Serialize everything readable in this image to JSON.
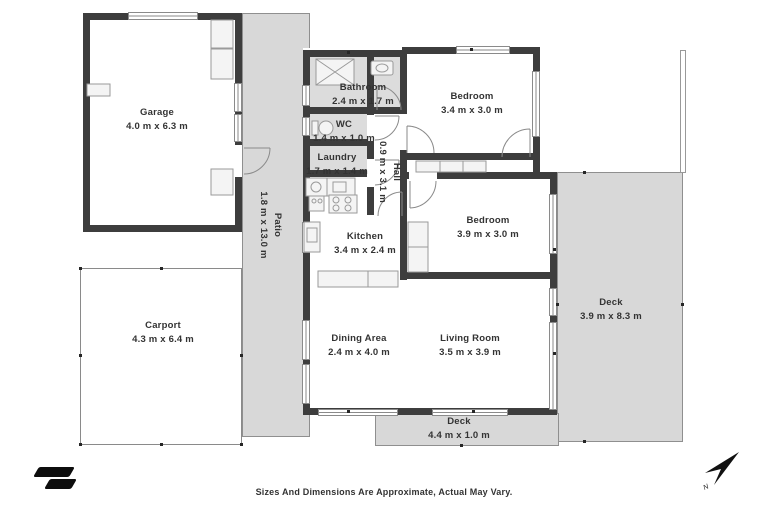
{
  "meta": {
    "footer_note": "Sizes And Dimensions Are Approximate, Actual May Vary.",
    "north_label": "N"
  },
  "colors": {
    "wall": "#3d3d3d",
    "outdoor_fill": "#d8d8d8",
    "wet_room_fill": "#dcdcdc",
    "fixture_line": "#9a9a9a",
    "label_text": "#333333"
  },
  "rooms": [
    {
      "id": "garage",
      "name": "Garage",
      "dimensions": "4.0 m x 6.3 m"
    },
    {
      "id": "carport",
      "name": "Carport",
      "dimensions": "4.3 m x 6.4 m"
    },
    {
      "id": "patio",
      "name": "Patio",
      "dimensions": "1.8 m x 13.0 m"
    },
    {
      "id": "bathroom",
      "name": "Bathroom",
      "dimensions": "2.4 m x 1.7 m"
    },
    {
      "id": "wc",
      "name": "WC",
      "dimensions": "1.4 m x 1.0 m"
    },
    {
      "id": "laundry",
      "name": "Laundry",
      "dimensions": "1.7 m x 1.4 m"
    },
    {
      "id": "hall",
      "name": "Hall",
      "dimensions": "0.9 m x 3.1 m"
    },
    {
      "id": "bedroom-north",
      "name": "Bedroom",
      "dimensions": "3.4 m x 3.0 m"
    },
    {
      "id": "bedroom-east",
      "name": "Bedroom",
      "dimensions": "3.9 m x 3.0 m"
    },
    {
      "id": "kitchen",
      "name": "Kitchen",
      "dimensions": "3.4 m x 2.4 m"
    },
    {
      "id": "dining",
      "name": "Dining Area",
      "dimensions": "2.4 m x 4.0 m"
    },
    {
      "id": "living",
      "name": "Living Room",
      "dimensions": "3.5 m x 3.9 m"
    },
    {
      "id": "deck-east",
      "name": "Deck",
      "dimensions": "3.9 m x 8.3 m"
    },
    {
      "id": "deck-south",
      "name": "Deck",
      "dimensions": "4.4 m x 1.0 m"
    }
  ]
}
